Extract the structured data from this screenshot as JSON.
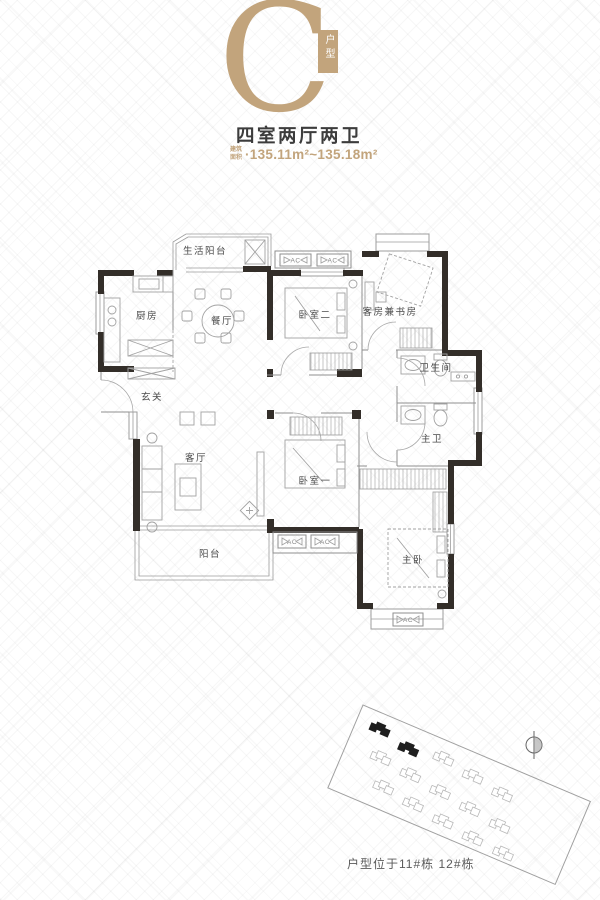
{
  "header": {
    "type_letter": "C",
    "type_badge": "户型",
    "title": "四室两厅两卫",
    "area_label": "建筑面积",
    "area_value": "·135.11m²~135.18m²",
    "accent_color": "#c2a47c"
  },
  "floorplan": {
    "ac_label": "AC",
    "rooms": [
      {
        "id": "life-balcony",
        "label": "生活阳台"
      },
      {
        "id": "kitchen",
        "label": "厨房"
      },
      {
        "id": "dining-room",
        "label": "餐厅"
      },
      {
        "id": "bedroom-2",
        "label": "卧室二"
      },
      {
        "id": "study",
        "label": "客房兼书房"
      },
      {
        "id": "bathroom",
        "label": "卫生间"
      },
      {
        "id": "foyer",
        "label": "玄关"
      },
      {
        "id": "living-room",
        "label": "客厅"
      },
      {
        "id": "bedroom-1",
        "label": "卧室一"
      },
      {
        "id": "master-bath",
        "label": "主卫"
      },
      {
        "id": "master-bedroom",
        "label": "主卧"
      },
      {
        "id": "balcony",
        "label": "阳台"
      }
    ]
  },
  "siteplan": {
    "caption": "户型位于11#栋 12#栋",
    "highlighted_buildings": [
      "11#栋",
      "12#栋"
    ]
  }
}
